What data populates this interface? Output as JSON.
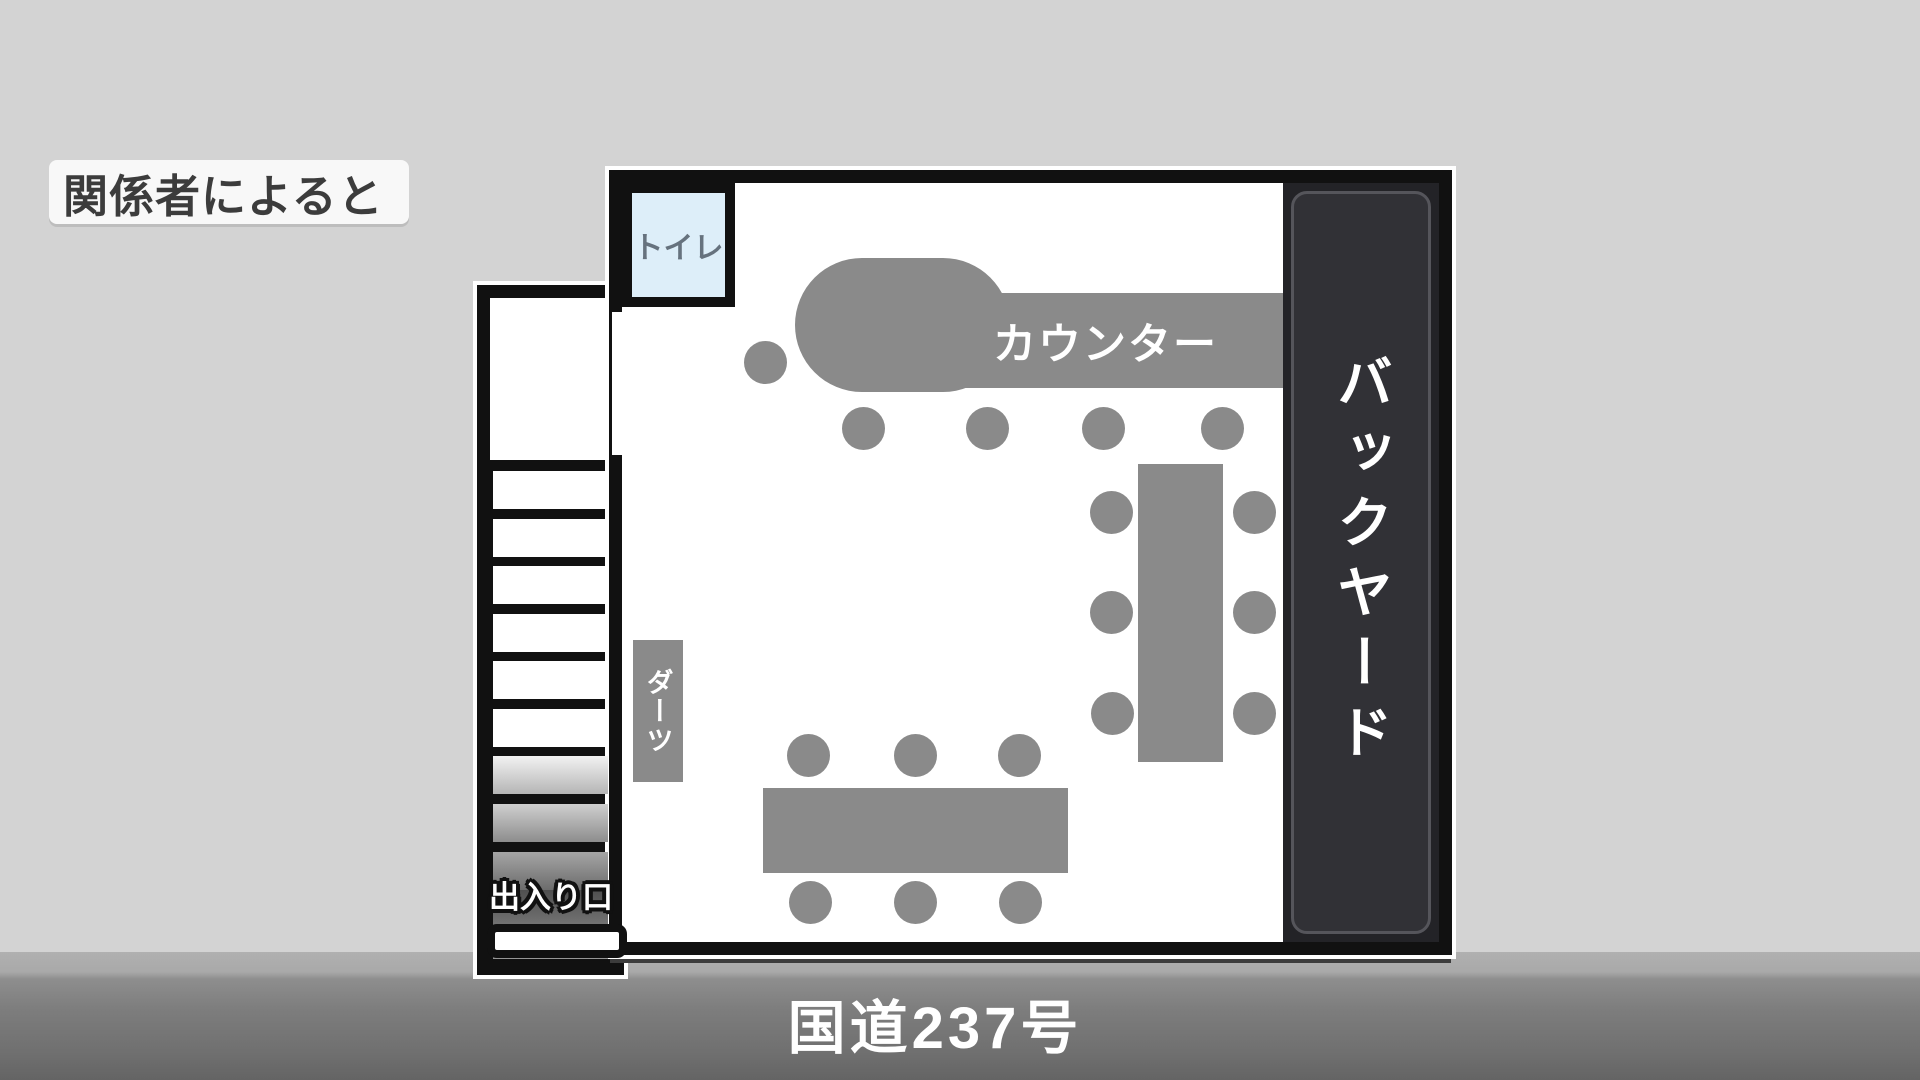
{
  "attribution": {
    "label": "関係者によると"
  },
  "road": {
    "label": "国道237号"
  },
  "plan": {
    "toilet_label": "トイレ",
    "counter_label": "カウンター",
    "backyard_label": "バックヤード",
    "darts_label": "ダーツ",
    "entrance_label": "出入り口"
  },
  "colors": {
    "background": "#d3d3d3",
    "wall": "#111111",
    "furniture": "#8a8a8a",
    "toilet_fill": "#ddeef9",
    "backyard_fill": "#313136",
    "road_fill": "#7d7d7d",
    "label_text": "#3c3c3c"
  },
  "layout": {
    "tables": [
      {
        "name": "table-right",
        "x": 1138,
        "y": 464,
        "w": 85,
        "h": 298
      },
      {
        "name": "table-bottom",
        "x": 763,
        "y": 788,
        "w": 305,
        "h": 85
      }
    ],
    "stools": [
      {
        "cx": 765,
        "cy": 362
      },
      {
        "cx": 863,
        "cy": 428
      },
      {
        "cx": 987,
        "cy": 428
      },
      {
        "cx": 1103,
        "cy": 428
      },
      {
        "cx": 1222,
        "cy": 428
      },
      {
        "cx": 1111,
        "cy": 512
      },
      {
        "cx": 1111,
        "cy": 612
      },
      {
        "cx": 1112,
        "cy": 713
      },
      {
        "cx": 1254,
        "cy": 512
      },
      {
        "cx": 1254,
        "cy": 612
      },
      {
        "cx": 1254,
        "cy": 713
      },
      {
        "cx": 808,
        "cy": 755
      },
      {
        "cx": 915,
        "cy": 755
      },
      {
        "cx": 1019,
        "cy": 755
      },
      {
        "cx": 810,
        "cy": 902
      },
      {
        "cx": 915,
        "cy": 902
      },
      {
        "cx": 1020,
        "cy": 902
      }
    ],
    "treads": [
      {
        "y": 471,
        "h": 38,
        "fill": "w"
      },
      {
        "y": 519,
        "h": 38,
        "fill": "w"
      },
      {
        "y": 566,
        "h": 38,
        "fill": "w"
      },
      {
        "y": 614,
        "h": 38,
        "fill": "w"
      },
      {
        "y": 661,
        "h": 38,
        "fill": "w"
      },
      {
        "y": 709,
        "h": 38,
        "fill": "w"
      },
      {
        "y": 756,
        "h": 38,
        "fill": "g1"
      },
      {
        "y": 804,
        "h": 38,
        "fill": "g2"
      },
      {
        "y": 852,
        "h": 38,
        "fill": "g3"
      },
      {
        "y": 890,
        "h": 69,
        "fill": "zone"
      }
    ]
  }
}
